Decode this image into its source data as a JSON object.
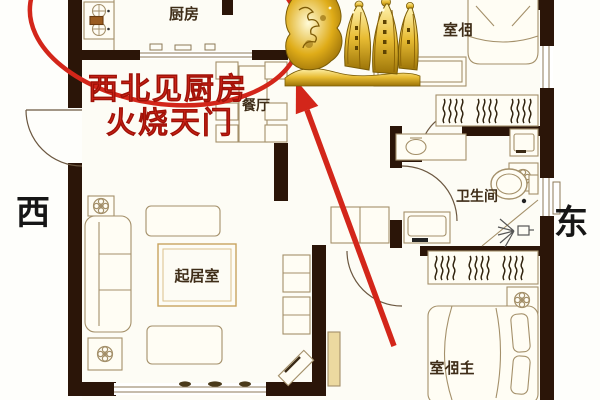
{
  "compass": {
    "west": "西",
    "east": "东"
  },
  "rooms": {
    "kitchen": {
      "label": "厨房"
    },
    "dining": {
      "label": "餐厅"
    },
    "living": {
      "label": "起居室"
    },
    "bedroom": {
      "label": "卧室",
      "mirrored": true
    },
    "bathroom": {
      "label": "卫生间"
    },
    "master_bedroom": {
      "label": "主卧室",
      "mirrored": true
    }
  },
  "annotation": {
    "line1": "西北见厨房",
    "line2": "火烧天门",
    "circle": "red-ellipse-around-northwest-kitchen",
    "arrow": "red-arrow-from-master-bedroom-toward-kitchen"
  },
  "icons": {
    "gold_ornament": "gold-dragon-ingot-ornament",
    "stove": "two-burner-stove",
    "sofa": "three-seat-sofa",
    "bed": "double-bed",
    "toilet": "toilet",
    "shower": "shower-spray",
    "sink": "bathroom-sink",
    "washer": "washing-machine",
    "closet": "folded-clothes-shelf",
    "plant": "potted-plant"
  },
  "colors": {
    "annotation_red": "#d3261a",
    "wall": "#2b1508",
    "furniture_line": "#a4906a",
    "label_text": "#3f2d18",
    "gold": "#e3b62a"
  }
}
